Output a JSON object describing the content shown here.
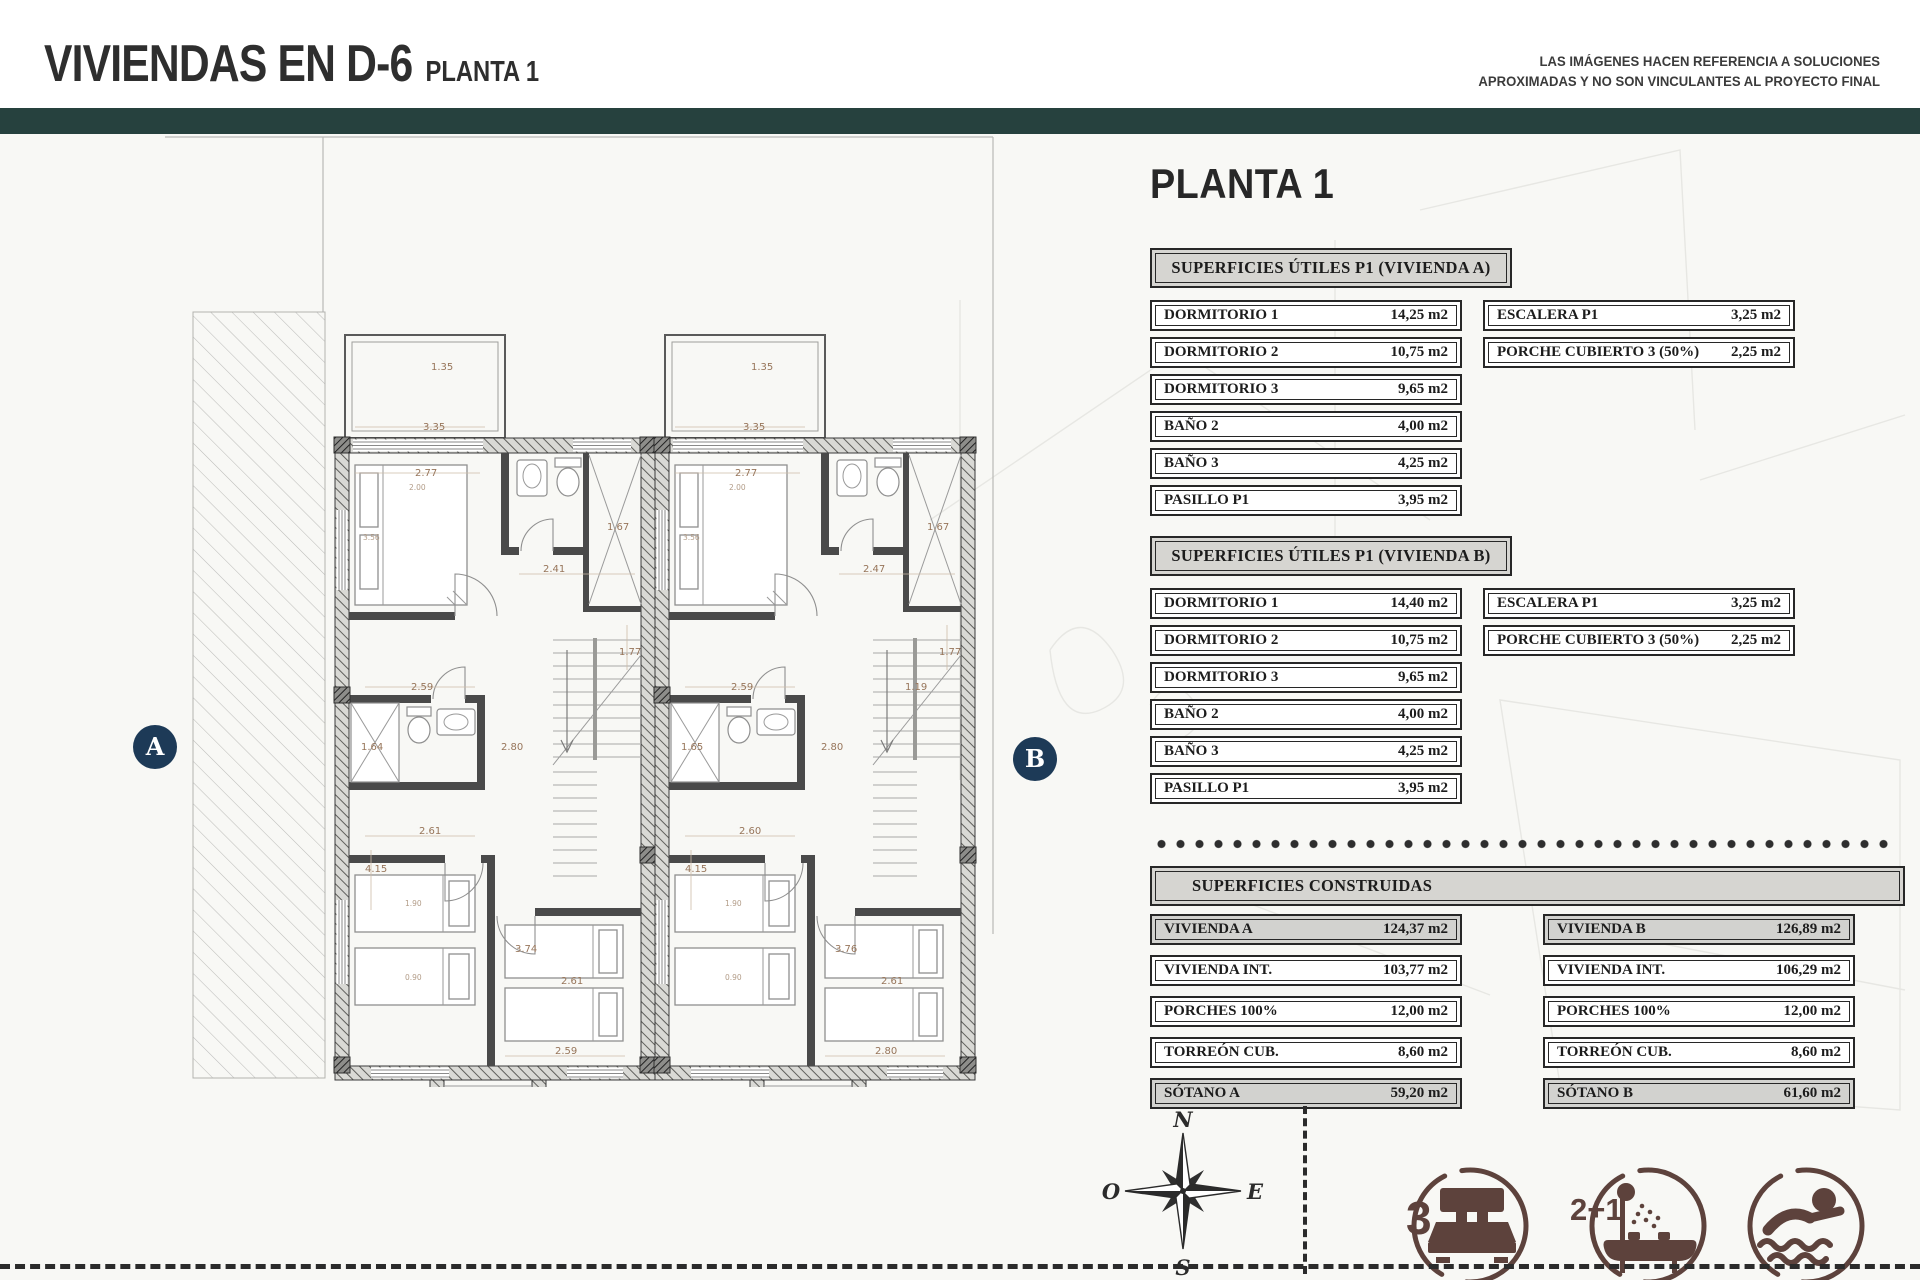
{
  "header": {
    "title": "VIVIENDAS EN D-6",
    "subtitle": "PLANTA 1",
    "disclaimer_line1": "LAS IMÁGENES HACEN REFERENCIA A SOLUCIONES",
    "disclaimer_line2": "APROXIMADAS Y NO SON VINCULANTES AL PROYECTO FINAL"
  },
  "panel": {
    "heading": "PLANTA 1",
    "section_a": {
      "title": "SUPERFICIES ÚTILES P1 (VIVIENDA A)",
      "rows": [
        {
          "label": "DORMITORIO 1",
          "value": "14,25 m2"
        },
        {
          "label": "DORMITORIO 2",
          "value": "10,75 m2"
        },
        {
          "label": "DORMITORIO 3",
          "value": "9,65 m2"
        },
        {
          "label": "BAÑO 2",
          "value": "4,00 m2"
        },
        {
          "label": "BAÑO 3",
          "value": "4,25 m2"
        },
        {
          "label": "PASILLO P1",
          "value": "3,95 m2"
        }
      ],
      "side_rows": [
        {
          "label": "ESCALERA P1",
          "value": "3,25 m2"
        },
        {
          "label": "PORCHE CUBIERTO 3 (50%)",
          "value": "2,25 m2"
        }
      ]
    },
    "section_b": {
      "title": "SUPERFICIES ÚTILES P1 (VIVIENDA B)",
      "rows": [
        {
          "label": "DORMITORIO 1",
          "value": "14,40 m2"
        },
        {
          "label": "DORMITORIO 2",
          "value": "10,75 m2"
        },
        {
          "label": "DORMITORIO 3",
          "value": "9,65 m2"
        },
        {
          "label": "BAÑO 2",
          "value": "4,00 m2"
        },
        {
          "label": "BAÑO 3",
          "value": "4,25 m2"
        },
        {
          "label": "PASILLO P1",
          "value": "3,95 m2"
        }
      ],
      "side_rows": [
        {
          "label": "ESCALERA P1",
          "value": "3,25 m2"
        },
        {
          "label": "PORCHE CUBIERTO 3 (50%)",
          "value": "2,25 m2"
        }
      ]
    },
    "construidas": {
      "title": "SUPERFICIES CONSTRUIDAS",
      "col_a": [
        {
          "label": "VIVIENDA A",
          "value": "124,37 m2"
        },
        {
          "label": "VIVIENDA INT.",
          "value": "103,77 m2"
        },
        {
          "label": "PORCHES 100%",
          "value": "12,00 m2"
        },
        {
          "label": "TORREÓN CUB.",
          "value": "8,60 m2"
        },
        {
          "label": "SÓTANO A",
          "value": "59,20 m2"
        }
      ],
      "col_b": [
        {
          "label": "VIVIENDA B",
          "value": "126,89 m2"
        },
        {
          "label": "VIVIENDA INT.",
          "value": "106,29 m2"
        },
        {
          "label": "PORCHES 100%",
          "value": "12,00 m2"
        },
        {
          "label": "TORREÓN CUB.",
          "value": "8,60 m2"
        },
        {
          "label": "SÓTANO B",
          "value": "61,60 m2"
        }
      ]
    }
  },
  "plan": {
    "marker_a": "A",
    "marker_b": "B",
    "compass": {
      "n": "N",
      "o": "O",
      "e": "E",
      "s": "S"
    },
    "dims_a": [
      {
        "t": "1.35",
        "x": 96,
        "y": 60
      },
      {
        "t": "3.35",
        "x": 88,
        "y": 120
      },
      {
        "t": "2.77",
        "x": 80,
        "y": 166
      },
      {
        "t": "2.00",
        "x": 74,
        "y": 180,
        "s": 1
      },
      {
        "t": "3.56",
        "x": 28,
        "y": 230,
        "s": 1
      },
      {
        "t": "2.41",
        "x": 208,
        "y": 262
      },
      {
        "t": "1.67",
        "x": 272,
        "y": 220
      },
      {
        "t": "1.77",
        "x": 284,
        "y": 345
      },
      {
        "t": "2.59",
        "x": 76,
        "y": 380
      },
      {
        "t": "1.64",
        "x": 26,
        "y": 440
      },
      {
        "t": "2.80",
        "x": 166,
        "y": 440
      },
      {
        "t": "2.61",
        "x": 84,
        "y": 524
      },
      {
        "t": "4.15",
        "x": 30,
        "y": 562
      },
      {
        "t": "1.90",
        "x": 70,
        "y": 596,
        "s": 1
      },
      {
        "t": "0.90",
        "x": 70,
        "y": 670,
        "s": 1
      },
      {
        "t": "3.74",
        "x": 180,
        "y": 642
      },
      {
        "t": "2.61",
        "x": 226,
        "y": 674
      },
      {
        "t": "2.59",
        "x": 220,
        "y": 744
      }
    ],
    "dims_b": [
      {
        "t": "1.35",
        "x": 96,
        "y": 60
      },
      {
        "t": "3.35",
        "x": 88,
        "y": 120
      },
      {
        "t": "2.77",
        "x": 80,
        "y": 166
      },
      {
        "t": "2.00",
        "x": 74,
        "y": 180,
        "s": 1
      },
      {
        "t": "3.56",
        "x": 28,
        "y": 230,
        "s": 1
      },
      {
        "t": "2.47",
        "x": 208,
        "y": 262
      },
      {
        "t": "1.67",
        "x": 272,
        "y": 220
      },
      {
        "t": "1.77",
        "x": 284,
        "y": 345
      },
      {
        "t": "2.59",
        "x": 76,
        "y": 380
      },
      {
        "t": "1.19",
        "x": 250,
        "y": 380
      },
      {
        "t": "1.65",
        "x": 26,
        "y": 440
      },
      {
        "t": "2.80",
        "x": 166,
        "y": 440
      },
      {
        "t": "2.60",
        "x": 84,
        "y": 524
      },
      {
        "t": "4.15",
        "x": 30,
        "y": 562
      },
      {
        "t": "1.90",
        "x": 70,
        "y": 596,
        "s": 1
      },
      {
        "t": "0.90",
        "x": 70,
        "y": 670,
        "s": 1
      },
      {
        "t": "3.76",
        "x": 180,
        "y": 642
      },
      {
        "t": "2.61",
        "x": 226,
        "y": 674
      },
      {
        "t": "2.80",
        "x": 220,
        "y": 744
      }
    ]
  },
  "legend": {
    "beds": "3",
    "baths": "2+1"
  }
}
